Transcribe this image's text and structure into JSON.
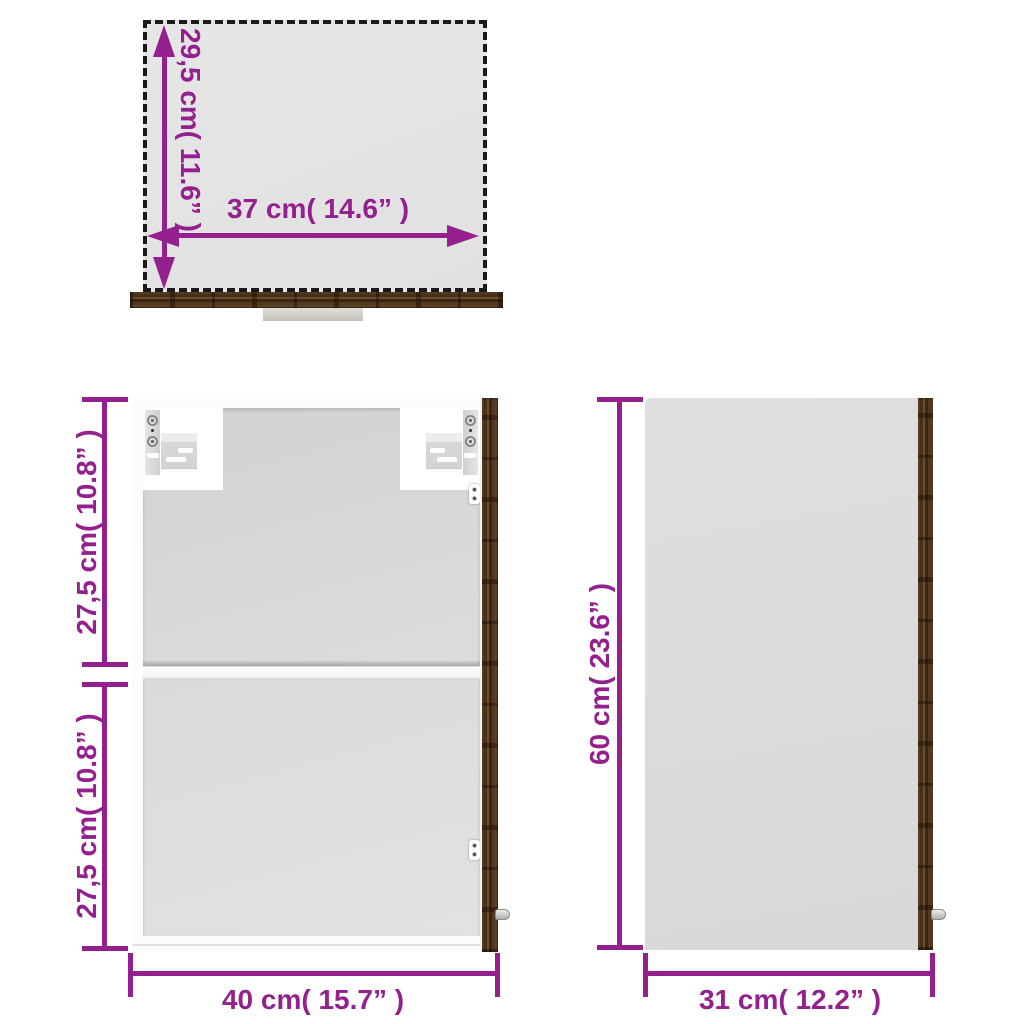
{
  "colors": {
    "accent_magenta": "#94208D",
    "dash_black": "#1A1A1A",
    "wood_brown": "#4A3119",
    "panel_gray": "#DBDBDB"
  },
  "views": {
    "top": {
      "name": "top view",
      "height": "29,5 cm( 11.6” )",
      "width": "37 cm( 14.6” )"
    },
    "front": {
      "name": "front view",
      "upper_height": "27,5 cm( 10.8” )",
      "lower_height": "27,5 cm( 10.8” )",
      "width": "40 cm( 15.7” )"
    },
    "side": {
      "name": "side view",
      "height": "60 cm( 23.6” )",
      "width": "31 cm( 12.2” )"
    }
  }
}
